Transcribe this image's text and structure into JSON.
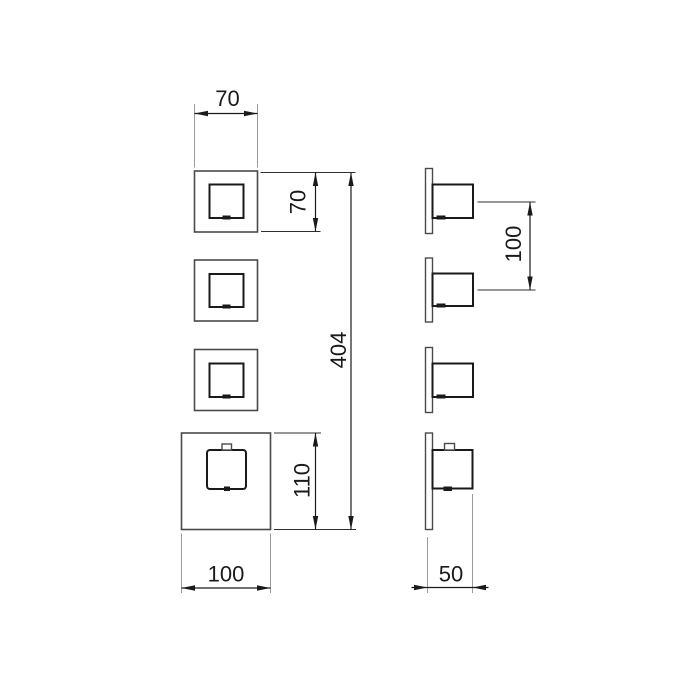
{
  "drawing": {
    "kind": "technical-dimension-drawing",
    "subject": "thermostatic-shower-trim-set-front-and-side-views",
    "units_shown": 4,
    "dimensions": {
      "front": {
        "trim_width_top": "70",
        "trim_height_right": "70",
        "overall_height": "404",
        "thermo_trim_height": "110",
        "thermo_trim_width": "100"
      },
      "side": {
        "valve_spacing": "100",
        "depth": "50"
      }
    },
    "colors": {
      "background": "#ffffff",
      "body_outline": "#4a4a4a",
      "handle_outline": "#1a1a1a",
      "dimension_line": "#1a1a1a",
      "extension_line": "#9a9a9a"
    }
  }
}
